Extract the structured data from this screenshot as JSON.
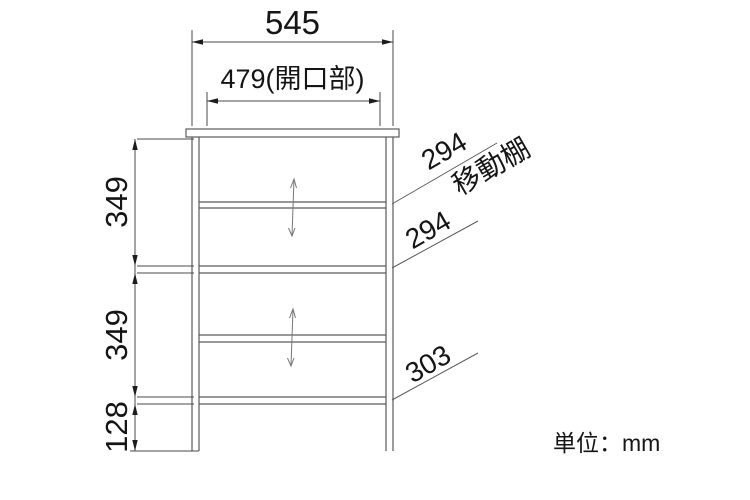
{
  "dimensions": {
    "overall_width": "545",
    "opening_width": "479(開口部)",
    "upper_section_height": "349",
    "lower_section_height": "349",
    "base_height": "128",
    "movable_shelf_depth": "294",
    "movable_shelf_note": "移動棚",
    "middle_shelf_depth": "294",
    "bottom_shelf_depth": "303"
  },
  "footer": {
    "unit_note": "単位：mm"
  },
  "colors": {
    "structure_line": "#5a5a5a",
    "dimension_line": "#4a4a4a",
    "text": "#151515"
  }
}
